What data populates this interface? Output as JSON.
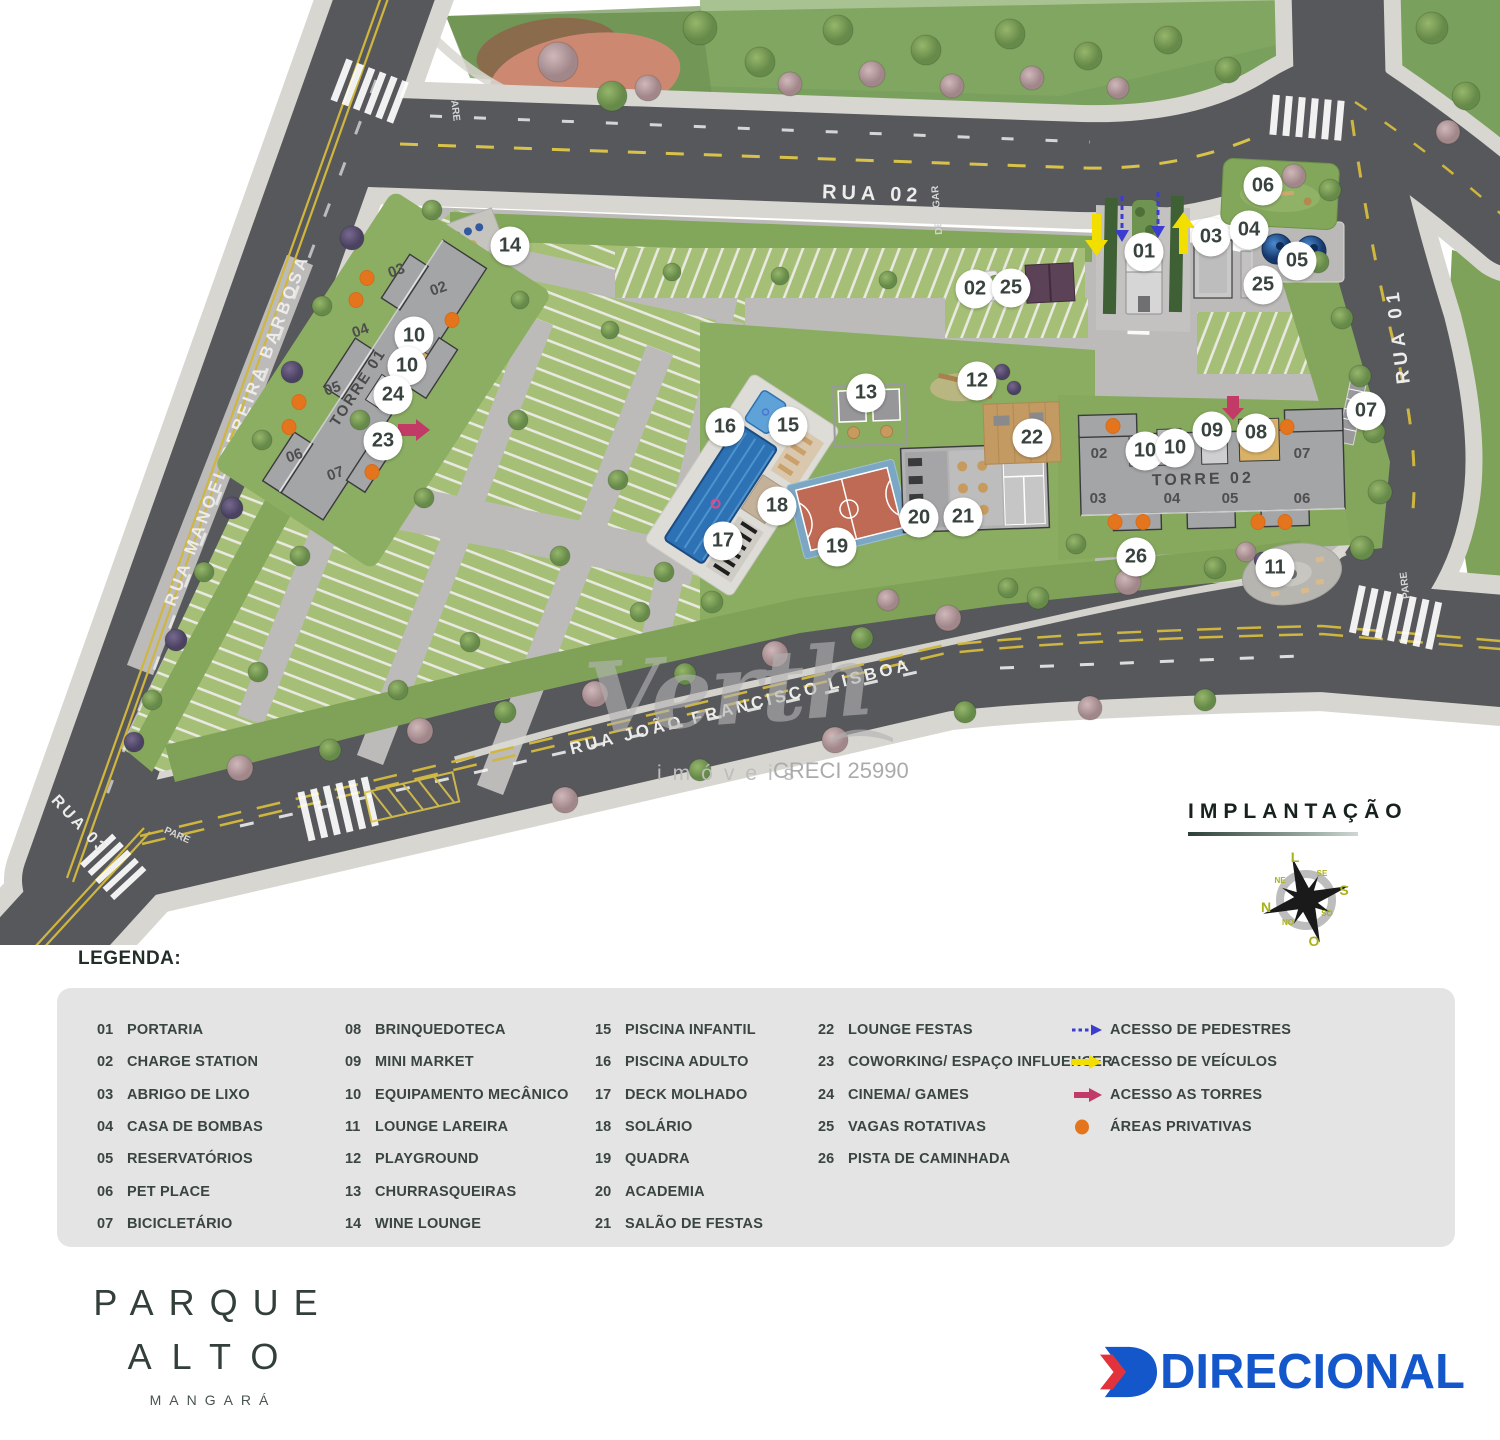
{
  "map": {
    "streets": {
      "rua02": "RUA 02",
      "rua01": "RUA 01",
      "rua03": "RUA 03",
      "manoel": "RUA MANOEL PEREIRA BARBOSA",
      "lisboa": "RUA JOÃO FRANCISCO LISBOA"
    },
    "signs": {
      "devagar": "DEVAGAR",
      "pare": "PARE"
    },
    "towers": [
      {
        "label": "TORRE 01",
        "units": [
          "03",
          "02",
          "04",
          "05",
          "06",
          "07"
        ]
      },
      {
        "label": "TORRE 02",
        "units": [
          "02",
          "07",
          "03",
          "04",
          "05",
          "06"
        ]
      }
    ],
    "markers": [
      {
        "n": "14",
        "x": 510,
        "y": 246
      },
      {
        "n": "10",
        "x": 414,
        "y": 336
      },
      {
        "n": "10",
        "x": 407,
        "y": 366
      },
      {
        "n": "24",
        "x": 393,
        "y": 395
      },
      {
        "n": "23",
        "x": 383,
        "y": 441
      },
      {
        "n": "16",
        "x": 725,
        "y": 427
      },
      {
        "n": "15",
        "x": 788,
        "y": 426
      },
      {
        "n": "13",
        "x": 866,
        "y": 393
      },
      {
        "n": "12",
        "x": 977,
        "y": 381
      },
      {
        "n": "22",
        "x": 1032,
        "y": 438
      },
      {
        "n": "18",
        "x": 777,
        "y": 506
      },
      {
        "n": "17",
        "x": 723,
        "y": 541
      },
      {
        "n": "19",
        "x": 837,
        "y": 547
      },
      {
        "n": "20",
        "x": 919,
        "y": 518
      },
      {
        "n": "21",
        "x": 963,
        "y": 517
      },
      {
        "n": "02",
        "x": 975,
        "y": 289
      },
      {
        "n": "25",
        "x": 1011,
        "y": 288
      },
      {
        "n": "01",
        "x": 1144,
        "y": 252
      },
      {
        "n": "03",
        "x": 1211,
        "y": 237
      },
      {
        "n": "04",
        "x": 1249,
        "y": 230
      },
      {
        "n": "06",
        "x": 1263,
        "y": 186
      },
      {
        "n": "05",
        "x": 1297,
        "y": 261
      },
      {
        "n": "25",
        "x": 1263,
        "y": 285
      },
      {
        "n": "09",
        "x": 1212,
        "y": 431
      },
      {
        "n": "08",
        "x": 1256,
        "y": 433
      },
      {
        "n": "10",
        "x": 1145,
        "y": 451
      },
      {
        "n": "10",
        "x": 1175,
        "y": 448
      },
      {
        "n": "07",
        "x": 1366,
        "y": 411
      },
      {
        "n": "26",
        "x": 1136,
        "y": 557
      },
      {
        "n": "11",
        "x": 1275,
        "y": 568
      }
    ],
    "private_dots": [
      [
        367,
        278
      ],
      [
        356,
        300
      ],
      [
        452,
        320
      ],
      [
        299,
        402
      ],
      [
        289,
        427
      ],
      [
        372,
        472
      ],
      [
        1113,
        426
      ],
      [
        1287,
        427
      ],
      [
        1115,
        522
      ],
      [
        1143,
        522
      ],
      [
        1258,
        522
      ],
      [
        1285,
        522
      ]
    ],
    "colors": {
      "pedestrian_access": "#3c3cd0",
      "vehicle_access": "#f2df00",
      "tower_access": "#c23a66",
      "private_area": "#e5751d"
    }
  },
  "watermark": {
    "brand": "Verth",
    "sub": "imóveis",
    "creci": "CRECI 25990"
  },
  "section": {
    "title": "IMPLANTAÇÃO"
  },
  "compass": {
    "n": "N",
    "s": "S",
    "e": "L",
    "w": "O",
    "ne": "NE",
    "se": "SE",
    "so": "SO",
    "no": "NO"
  },
  "legend": {
    "title": "LEGENDA:",
    "columns": [
      [
        {
          "num": "01",
          "label": "PORTARIA"
        },
        {
          "num": "02",
          "label": "CHARGE STATION"
        },
        {
          "num": "03",
          "label": "ABRIGO DE LIXO"
        },
        {
          "num": "04",
          "label": "CASA DE BOMBAS"
        },
        {
          "num": "05",
          "label": "RESERVATÓRIOS"
        },
        {
          "num": "06",
          "label": "PET PLACE"
        },
        {
          "num": "07",
          "label": "BICICLETÁRIO"
        }
      ],
      [
        {
          "num": "08",
          "label": "BRINQUEDOTECA"
        },
        {
          "num": "09",
          "label": "MINI MARKET"
        },
        {
          "num": "10",
          "label": "EQUIPAMENTO MECÂNICO"
        },
        {
          "num": "11",
          "label": "LOUNGE LAREIRA"
        },
        {
          "num": "12",
          "label": "PLAYGROUND"
        },
        {
          "num": "13",
          "label": "CHURRASQUEIRAS"
        },
        {
          "num": "14",
          "label": "WINE LOUNGE"
        }
      ],
      [
        {
          "num": "15",
          "label": "PISCINA INFANTIL"
        },
        {
          "num": "16",
          "label": "PISCINA ADULTO"
        },
        {
          "num": "17",
          "label": "DECK MOLHADO"
        },
        {
          "num": "18",
          "label": "SOLÁRIO"
        },
        {
          "num": "19",
          "label": "QUADRA"
        },
        {
          "num": "20",
          "label": "ACADEMIA"
        },
        {
          "num": "21",
          "label": "SALÃO DE FESTAS"
        }
      ],
      [
        {
          "num": "22",
          "label": "LOUNGE FESTAS"
        },
        {
          "num": "23",
          "label": "COWORKING/ ESPAÇO INFLUENCER"
        },
        {
          "num": "24",
          "label": "CINEMA/ GAMES"
        },
        {
          "num": "25",
          "label": "VAGAS ROTATIVAS"
        },
        {
          "num": "26",
          "label": "PISTA DE CAMINHADA"
        }
      ]
    ],
    "access": [
      {
        "kind": "pedestrian",
        "label": "ACESSO DE PEDESTRES"
      },
      {
        "kind": "vehicle",
        "label": "ACESSO DE VEÍCULOS"
      },
      {
        "kind": "towers",
        "label": "ACESSO AS TORRES"
      },
      {
        "kind": "private",
        "label": "ÁREAS PRIVATIVAS"
      }
    ]
  },
  "logos": {
    "project": {
      "line1": "PARQUE",
      "line2": "ALTO",
      "line3": "MANGARÁ"
    },
    "developer": {
      "name": "DIRECIONAL"
    }
  }
}
